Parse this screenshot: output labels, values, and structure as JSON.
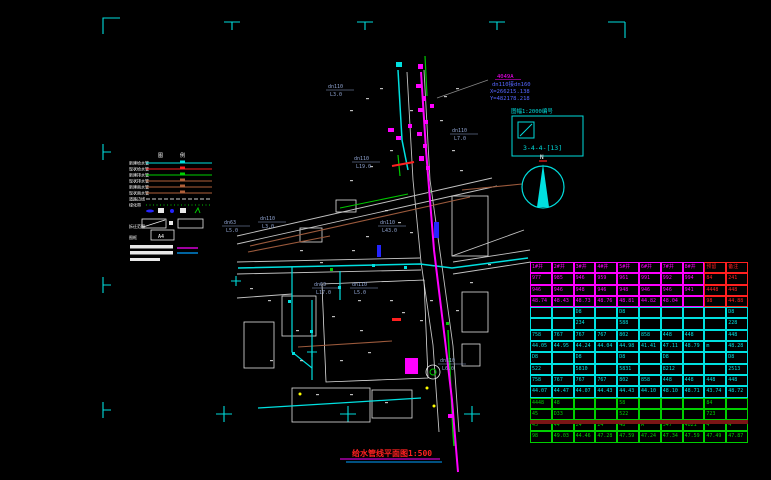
{
  "title": {
    "text": "给水管线平面图1:500"
  },
  "north": {
    "label": "N"
  },
  "annotation": {
    "id": "4049A",
    "line1": "dn110接dn160",
    "line2": "X=266215.138",
    "line3": "Y=482178.218"
  },
  "sheet_box": {
    "label": "图幅1:2000编号",
    "code": "3-4-4-[13]"
  },
  "legend": {
    "header": [
      "图",
      "例"
    ],
    "items": [
      {
        "label": "新建给水管",
        "color": "#00e0e0",
        "dash": ""
      },
      {
        "label": "现状给水管",
        "color": "#ff2020",
        "dash": ""
      },
      {
        "label": "新建排水管",
        "color": "#00d000",
        "dash": ""
      },
      {
        "label": "现状排水管",
        "color": "#b0603a",
        "dash": ""
      },
      {
        "label": "新建雨水管",
        "color": "#b0603a",
        "dash": ""
      },
      {
        "label": "现状雨水管",
        "color": "#b0603a",
        "dash": ""
      },
      {
        "label": "道路边线",
        "color": "#d0d0d0",
        "dash": "4,2"
      },
      {
        "label": "绿化带",
        "color": "#00c000",
        "dash": "1,2.5"
      }
    ],
    "symbols": [
      "valve-symbol",
      "meter-box-symbol",
      "water-meter-symbol",
      "junction-box-symbol",
      "hydrant-symbol"
    ],
    "rect_row": {
      "label": "拆迁范围"
    },
    "frame_row": {
      "label": "图框",
      "code": "A4"
    }
  },
  "map": {
    "pipe_labels": [
      {
        "dn": "dn110",
        "len": "L3.0"
      },
      {
        "dn": "dn110",
        "len": "L19.0"
      },
      {
        "dn": "dn110",
        "len": "L7.0"
      },
      {
        "dn": "dn63",
        "len": "L5.0"
      },
      {
        "dn": "dn110",
        "len": "L3.0"
      },
      {
        "dn": "dn110",
        "len": "L43.0"
      },
      {
        "dn": "dn63",
        "len": "L17.0"
      },
      {
        "dn": "dn110",
        "len": "L5.0"
      },
      {
        "dn": "dn110",
        "len": "L6.0"
      }
    ]
  },
  "colors": {
    "background": "#000000",
    "frame": "#00dcdc",
    "water_pipe": "#00e0e0",
    "main_pipe": "#ff00ff",
    "green_pipe": "#00c800",
    "existing": "#9c5a3c",
    "road": "#d8d8d8",
    "label_blue": "#8fa3d0",
    "title_red": "#ff2020",
    "table_bar": "#7a1515"
  },
  "table": {
    "groups": [
      {
        "color": "#ff00ff",
        "alt_color": "#ff2020",
        "alt_cols": [
          8,
          9
        ],
        "rows": [
          [
            "1#井",
            "2#井",
            "3#井",
            "4#井",
            "5#井",
            "6#井",
            "7#井",
            "8#井",
            "预留",
            "备注"
          ],
          [
            "977",
            "985",
            "946",
            "959",
            "961",
            "991",
            "992",
            "994",
            "84",
            "241"
          ],
          [
            "946",
            "946",
            "948",
            "946",
            "948",
            "946",
            "946",
            "941",
            "4448",
            "448"
          ],
          [
            "48.74",
            "48.43",
            "48.73",
            "48.76",
            "48.81",
            "44.82",
            "48.04",
            "",
            "98",
            "44.88"
          ]
        ]
      },
      {
        "color": "#00e0e0",
        "rows": [
          [
            "",
            "",
            "D8",
            "",
            "D8",
            "",
            "",
            "",
            "",
            "D8"
          ],
          [
            "",
            "",
            "234",
            "",
            "588",
            "",
            "",
            "",
            "",
            "228"
          ],
          [
            "758",
            "767",
            "767",
            "767",
            "802",
            "858",
            "448",
            "448",
            "",
            "448"
          ],
          [
            "44.05",
            "44.95",
            "44.24",
            "44.04",
            "44.98",
            "41.41",
            "47.11",
            "48.79",
            "m",
            "48.28"
          ]
        ]
      },
      {
        "color": "#00e0e0",
        "rows": [
          [
            "D8",
            "",
            "D8",
            "",
            "D8",
            "",
            "D8",
            "",
            "",
            "D8"
          ],
          [
            "522",
            "",
            "5810",
            "",
            "5831",
            "",
            "8212",
            "",
            "",
            "2513"
          ],
          [
            "758",
            "767",
            "767",
            "767",
            "802",
            "858",
            "448",
            "448",
            "448",
            "448"
          ],
          [
            "44.07",
            "44.47",
            "44.07",
            "44.43",
            "44.43",
            "44.10",
            "48.10",
            "48.71",
            "43.74",
            "48.72"
          ]
        ]
      },
      {
        "color": "#00d000",
        "rows": [
          [
            "4448",
            "48",
            "",
            "",
            "58",
            "",
            "",
            "",
            "84",
            ""
          ],
          [
            "45",
            "D33",
            "",
            "",
            "522",
            "",
            "",
            "",
            "723",
            ""
          ],
          [
            "45",
            "44",
            "24",
            "24",
            "48",
            "A",
            "547",
            "4821",
            "4",
            "4"
          ],
          [
            "98",
            "49.03",
            "44.46",
            "47.28",
            "47.59",
            "47.24",
            "47.34",
            "47.59",
            "47.49",
            "47.87"
          ]
        ]
      }
    ]
  }
}
